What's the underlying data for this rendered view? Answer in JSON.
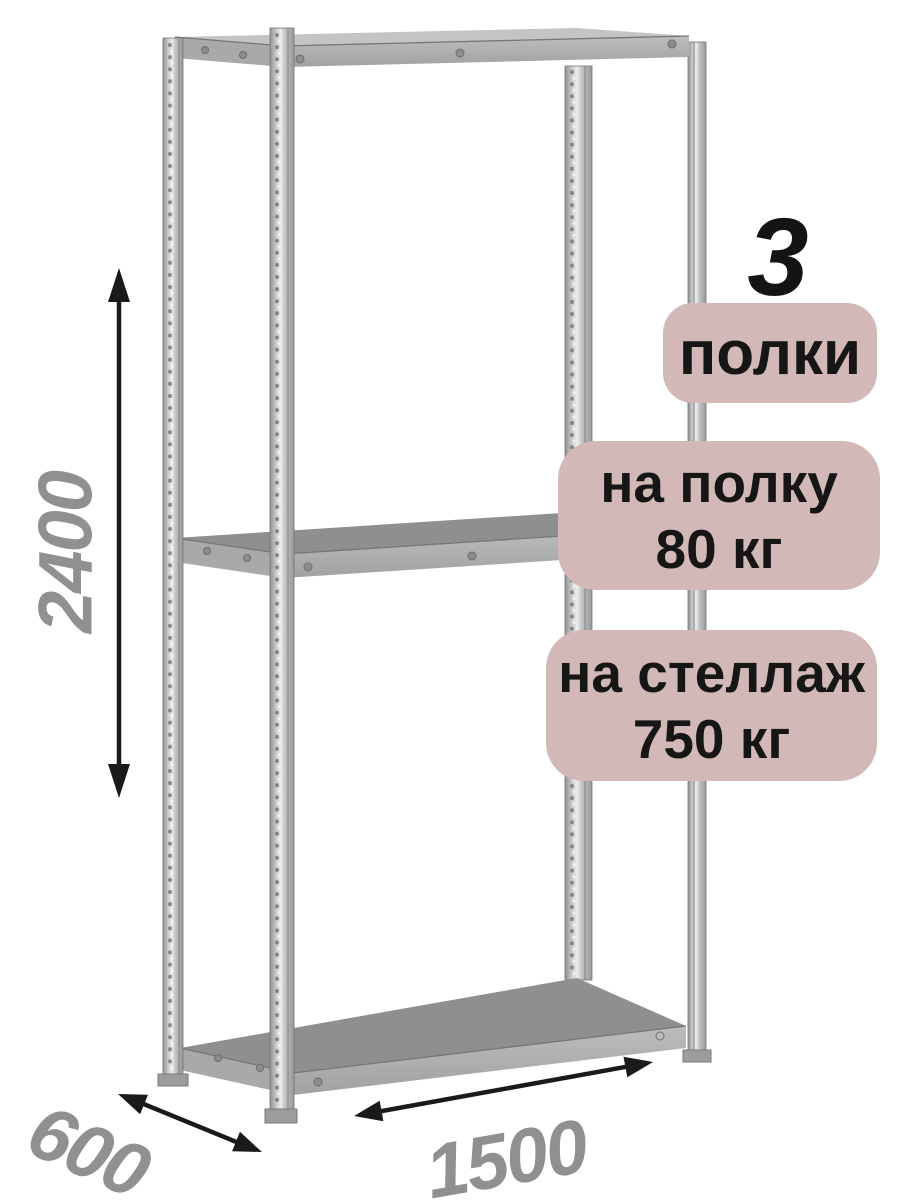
{
  "badges": {
    "count": "3",
    "count_label": "полки",
    "per_shelf": {
      "line1": "на полку",
      "line2": "80 кг"
    },
    "per_rack": {
      "line1": "на стеллаж",
      "line2": "750 кг"
    }
  },
  "dimensions": {
    "height": "2400",
    "depth": "600",
    "width": "1500"
  },
  "colors": {
    "badge_bg": "#d3b8b8",
    "badge_text": "#161616",
    "dimension_label": "#8f9092",
    "arrow": "#1a1a1a",
    "metal_light": "#eceded",
    "metal_mid": "#b2b4b6",
    "metal_dark": "#8c8e90"
  }
}
